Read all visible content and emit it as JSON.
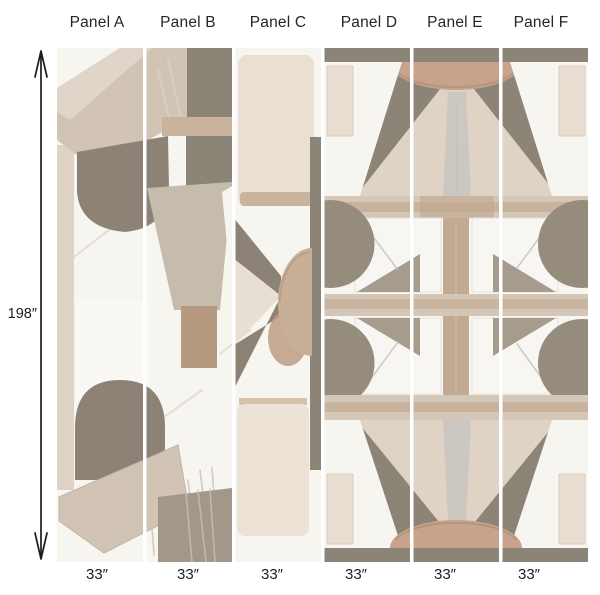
{
  "diagram": {
    "type": "wallpaper-panel-layout",
    "height_label": "198″"
  },
  "panels": [
    {
      "name": "Panel A",
      "width_label": "33″"
    },
    {
      "name": "Panel B",
      "width_label": "33″"
    },
    {
      "name": "Panel C",
      "width_label": "33″"
    },
    {
      "name": "Panel D",
      "width_label": "33″"
    },
    {
      "name": "Panel E",
      "width_label": "33″"
    },
    {
      "name": "Panel F",
      "width_label": "33″"
    }
  ],
  "palette": {
    "bg": "#f7f5f0",
    "dark": "#8c8376",
    "darkField": "#8d8478",
    "circle": "#968c7e",
    "bandLight": "#d4c7b8",
    "bandCore": "#c4ad96",
    "tanDome": "#c7a28c",
    "tanStem": "#c2a992",
    "triLight": "#ded3c5",
    "cream": "#e9dfd2",
    "creamBlock": "#ece2d5",
    "cornerBeige": "#e7ddd0",
    "slab": "#d2c4b4",
    "slabLight": "#e1d7ca",
    "taupeTrap": "#c6bcae",
    "warmBrown": "#b49880",
    "leftStrip": "#d9ccbd",
    "bottomDark": "#a29789",
    "sun": "#c8b098",
    "fascia": "#c9b39c",
    "arrow": "#1c1c1c"
  }
}
